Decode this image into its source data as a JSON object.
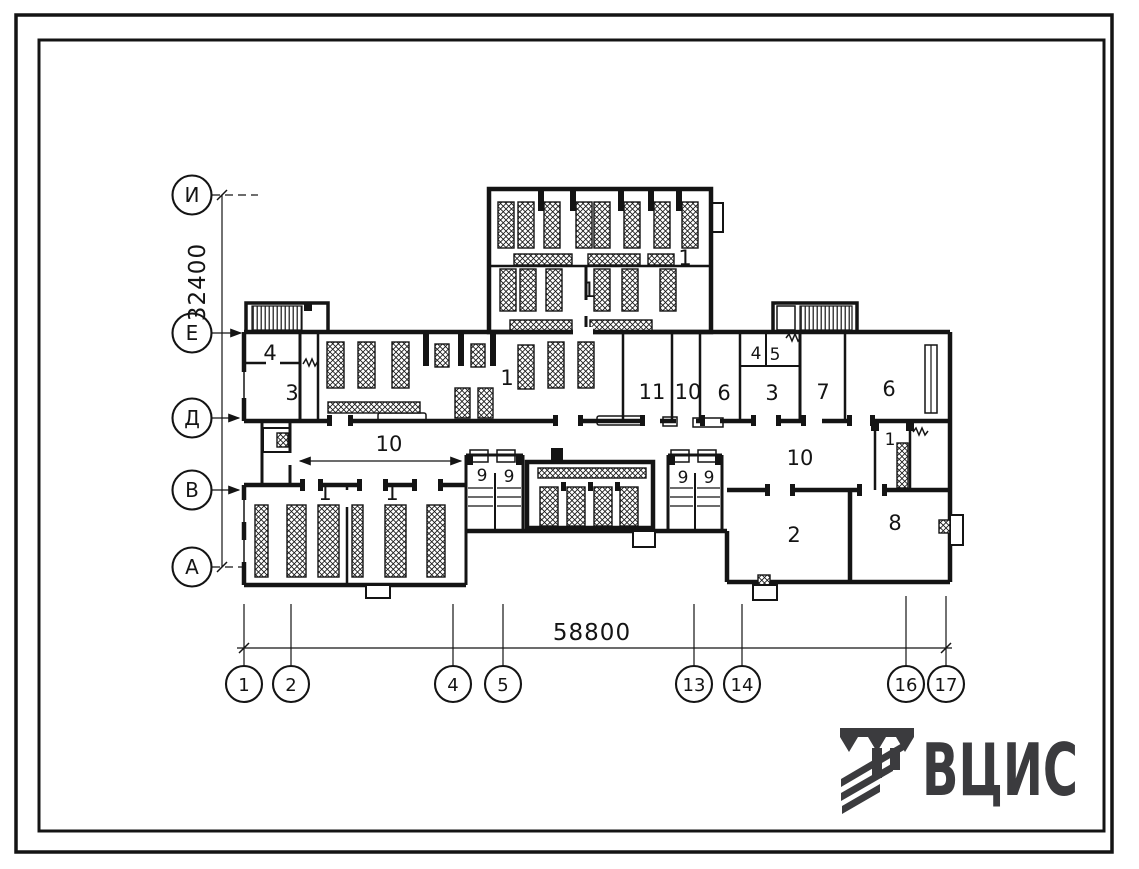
{
  "sheet": {
    "kind": "architectural floor plan scan"
  },
  "axis_rows": {
    "items": [
      {
        "label": "И"
      },
      {
        "label": "Е"
      },
      {
        "label": "Д"
      },
      {
        "label": "В"
      },
      {
        "label": "А"
      }
    ]
  },
  "axis_cols": {
    "items": [
      {
        "label": "1"
      },
      {
        "label": "2"
      },
      {
        "label": "4"
      },
      {
        "label": "5"
      },
      {
        "label": "13"
      },
      {
        "label": "14"
      },
      {
        "label": "16"
      },
      {
        "label": "17"
      }
    ]
  },
  "dimensions": {
    "vertical_mm": "32400",
    "horizontal_mm": "58800"
  },
  "room_labels": [
    {
      "t": "4"
    },
    {
      "t": "3"
    },
    {
      "t": "1"
    },
    {
      "t": "11"
    },
    {
      "t": "10"
    },
    {
      "t": "6"
    },
    {
      "t": "3"
    },
    {
      "t": "4"
    },
    {
      "t": "5"
    },
    {
      "t": "7"
    },
    {
      "t": "6"
    },
    {
      "t": "1"
    },
    {
      "t": "1"
    },
    {
      "t": "10"
    },
    {
      "t": "10"
    },
    {
      "t": "1"
    },
    {
      "t": "1"
    },
    {
      "t": "9"
    },
    {
      "t": "9"
    },
    {
      "t": "9"
    },
    {
      "t": "9"
    },
    {
      "t": "1"
    },
    {
      "t": "2"
    },
    {
      "t": "8"
    }
  ],
  "logo": {
    "text": "ВЦИС",
    "color": "#3b3b3e"
  }
}
